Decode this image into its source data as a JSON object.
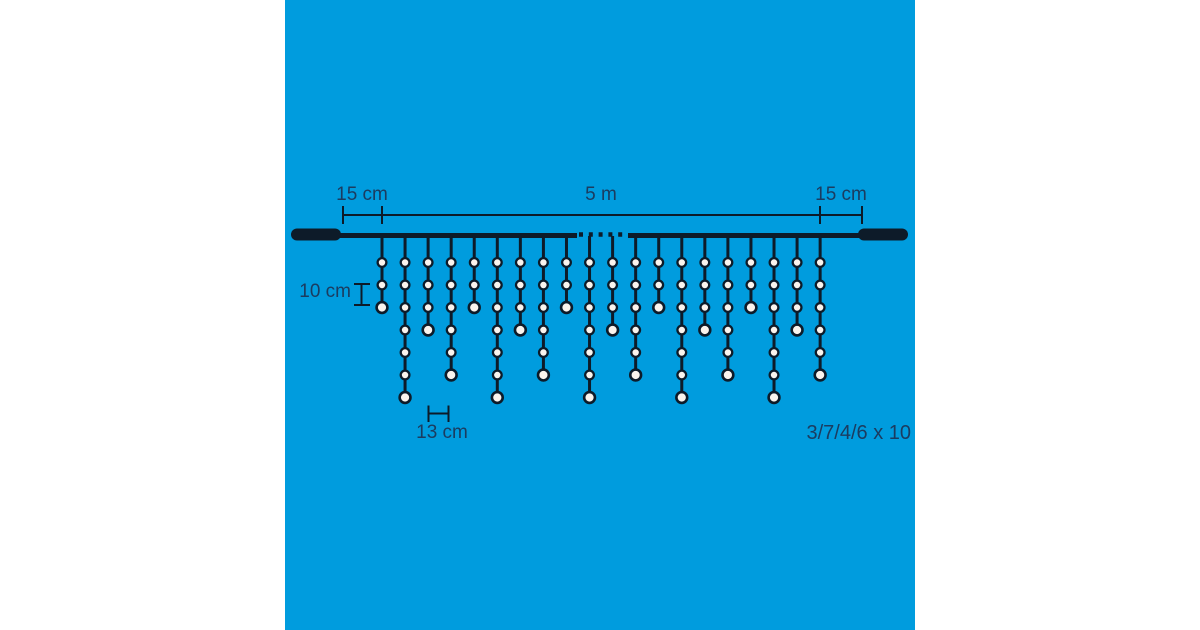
{
  "colors": {
    "page_background": "#ffffff",
    "image_background": "#009cde",
    "line_ink": "#0d1b29",
    "label_text": "#1b3c60",
    "bulb_fill": "#faf4ee"
  },
  "diagram": {
    "labels": {
      "lead_left": "15 cm",
      "total_span": "5 m",
      "lead_right": "15 cm",
      "bulb_spacing": "10 cm",
      "drop_spacing": "13 cm",
      "drop_pattern": "3/7/4/6 x 10"
    },
    "pattern_sequence": [
      3,
      7,
      4,
      6
    ],
    "pattern_repeat": 10,
    "drops_shown": [
      3,
      7,
      4,
      6,
      3,
      7,
      4,
      6,
      3,
      7,
      4,
      6,
      3,
      7,
      4,
      6,
      3,
      7,
      4,
      6
    ]
  }
}
